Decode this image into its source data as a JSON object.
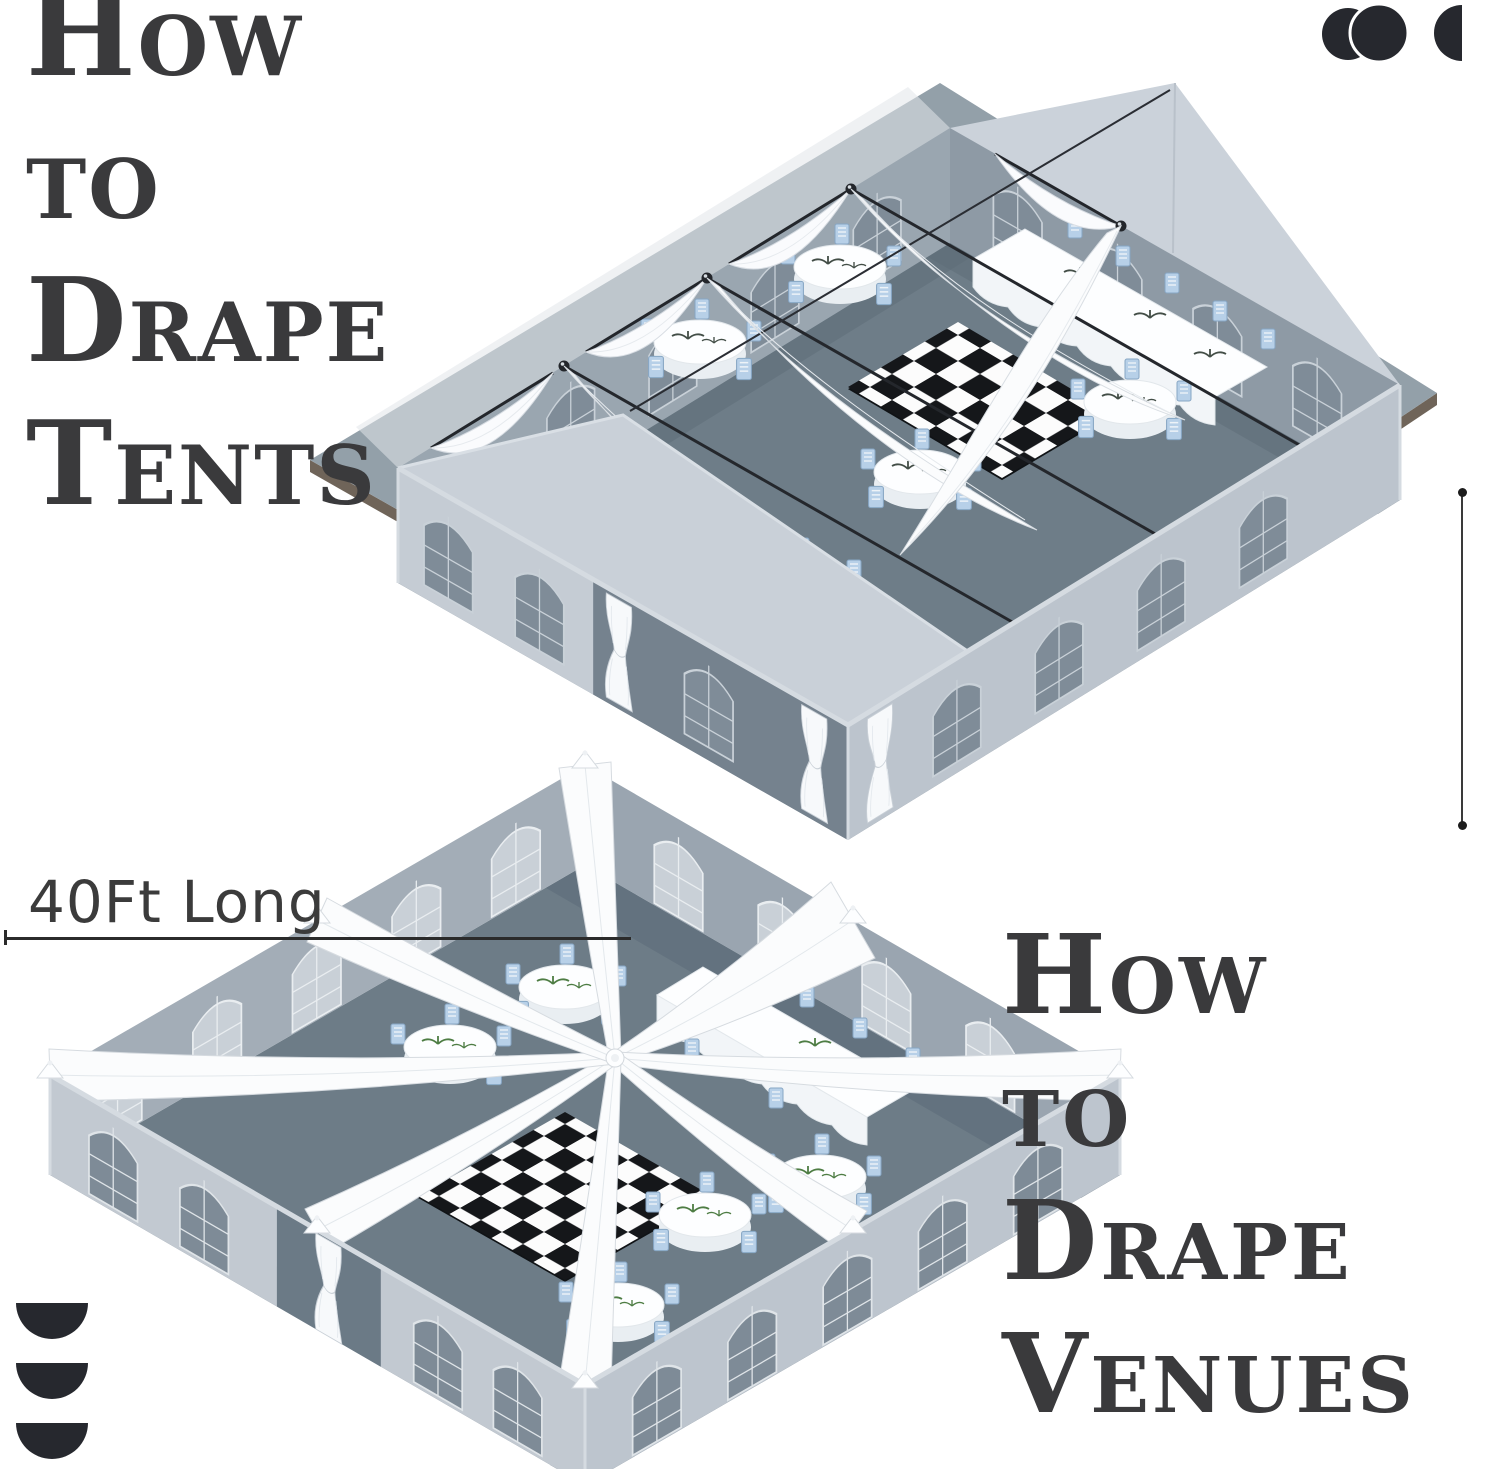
{
  "titles": {
    "tents": [
      "How",
      "to",
      "Drape",
      "Tents"
    ],
    "venues": [
      "How",
      "to",
      "Drape",
      "Venues"
    ]
  },
  "labels": {
    "dimension": "40Ft Long"
  },
  "icons": {
    "top_right": "overlapping-circles-icon",
    "bottom_left": "stacked-half-circles-icon"
  },
  "colors": {
    "background": "#ffffff",
    "title_text": "#3a3a3c",
    "label_text": "#3b3b3b",
    "icon": "#26282e",
    "dimension_line": "#2b2b2b",
    "wall_exterior_light": "#c2c9d1",
    "wall_exterior_mid": "#bcc4cd",
    "wall_interior": "#9aa6b0",
    "wall_shadow": "#75828e",
    "gable": "#cbd2da",
    "floor": "#6d7c87",
    "floor_shadow": "#5e6d79",
    "platform_edge": "#6f6459",
    "window_dark": "#7e8b97",
    "window_light": "#c9d0d7",
    "drape_white": "#fbfcfd",
    "drape_edge": "#d6dbe0",
    "chair_blue": "#b7d0e8",
    "checker_dark": "#15171a",
    "checker_light": "#fcfcfc",
    "sprig_green": "#4e7d44",
    "sprig_dark": "#434e47"
  }
}
